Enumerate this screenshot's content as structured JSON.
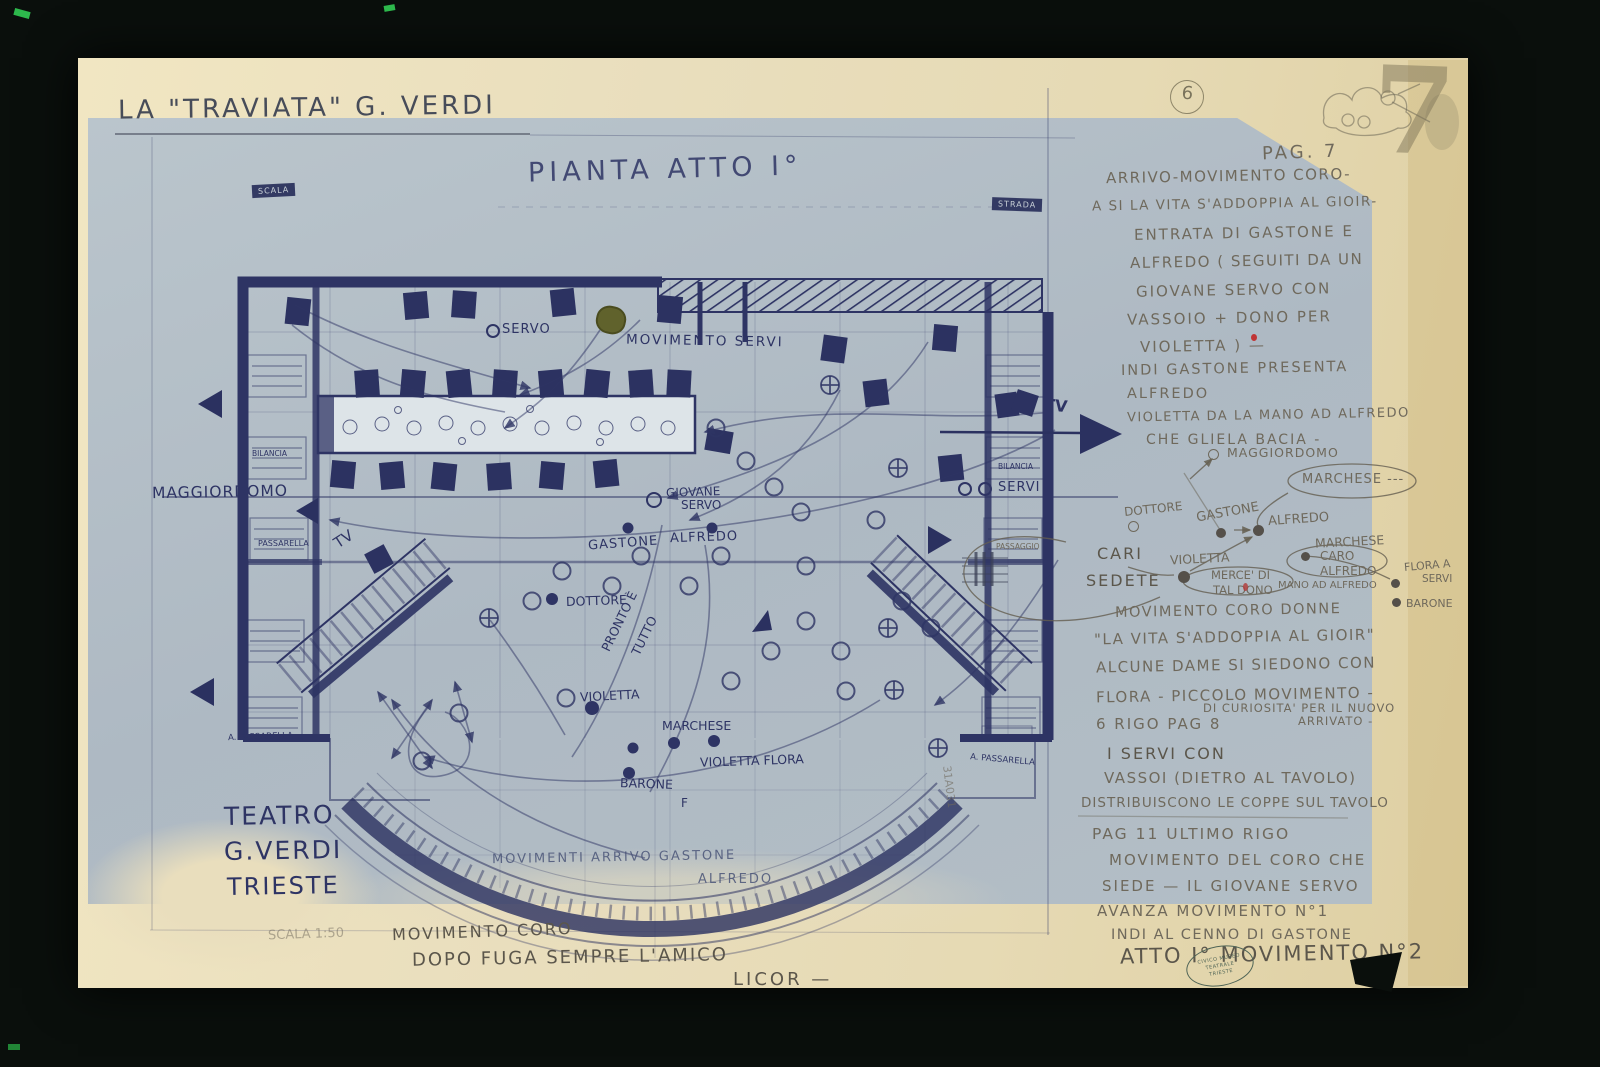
{
  "document": {
    "header_title": "LA \"TRAVIATA\"  G. VERDI",
    "plan_title": "PIANTA ATTO I°",
    "page_circled": "6",
    "page_watermark": "7",
    "theater": {
      "line1": "TEATRO",
      "line2": "G.VERDI",
      "line3": "TRIESTE",
      "scale": "SCALA 1:50"
    },
    "footer": {
      "line1": "MOVIMENTO CORO",
      "line2": "DOPO FUGA SEMPRE L'AMICO",
      "line3": "LICOR —"
    },
    "stamp": {
      "line1": "CIVICO MUSEO",
      "line2": "TEATRALE",
      "line3": "TRIESTE"
    }
  },
  "notes": {
    "pag": "PAG. 7",
    "p1l1": "ARRIVO-MOVIMENTO CORO-",
    "p1l2": "A SI LA VITA S'ADDOPPIA AL GIOIR-",
    "p1l3": "ENTRATA DI GASTONE E",
    "p1l4": "ALFREDO ( SEGUITI DA UN",
    "p1l5": "GIOVANE SERVO CON",
    "p1l6": "VASSOIO + DONO PER",
    "p1l7": "VIOLETTA ) —",
    "p2l1": "INDI GASTONE PRESENTA",
    "p2l2": "ALFREDO",
    "p3l1": "VIOLETTA DA LA MANO AD ALFREDO",
    "p3l2": "CHE GLIELA BACIA -",
    "p4l1": "MOVIMENTO CORO DONNE",
    "p4l2": "\"LA VITA S'ADDOPPIA AL GIOIR\"",
    "p4l3": "ALCUNE DAME SI SIEDONO CON",
    "p4l4": "FLORA - PICCOLO MOVIMENTO -",
    "p4l5": "DI CURIOSITA' PER IL NUOVO",
    "p4l6": "ARRIVATO -",
    "p4l7": "6 RIGO PAG 8",
    "p5l1": "I SERVI CON",
    "p5l2": "VASSOI (DIETRO AL TAVOLO)",
    "p5l3": "DISTRIBUISCONO LE COPPE SUL TAVOLO",
    "p6l1": "PAG 11 ULTIMO RIGO",
    "p6l2": "MOVIMENTO DEL CORO CHE",
    "p6l3": "SIEDE — IL GIOVANE SERVO",
    "p6l4": "AVANZA MOVIMENTO N°1",
    "p6l5": "INDI AL CENNO DI GASTONE",
    "atto": "ATTO I° MOVIMENTO N°2"
  },
  "cluster": {
    "maggiordomo": "MAGGIORDOMO",
    "marchese_bubble": "MARCHESE ---",
    "dottore": "DOTTORE",
    "gastone": "GASTONE",
    "alfredo": "ALFREDO",
    "marchese": "MARCHESE",
    "cari": "CARI",
    "sedete": "SEDETE",
    "violetta": "VIOLETTA",
    "caro1": "CARO",
    "caro2": "ALFREDO",
    "merce1": "MERCE' DI",
    "merce2": "TAL DONO",
    "mano": "MANO AD ALFREDO",
    "flora1": "FLORA A",
    "flora2": "SERVI",
    "barone": "BARONE"
  },
  "stage": {
    "scala_box": "SCALA",
    "strada_box": "STRADA",
    "servo": "SERVO",
    "movimento_servi": "MOVIMENTO SERVI",
    "tv_left": "TV",
    "tv_right": "TV",
    "maggiordomo": "MAGGIORDOMO",
    "passarella": "PASSARELLA",
    "bilancia_left": "BILANCIA",
    "bilancia_right": "BILANCIA",
    "passaggio": "PASSAGGIO",
    "servi": "SERVI",
    "giovane1": "GIOVANE",
    "giovane2": "SERVO",
    "gastone": "GASTONE",
    "alfredo": "ALFREDO",
    "dottore": "DOTTORE",
    "pronto1": "PRONTO È",
    "pronto2": "TUTTO",
    "violetta": "VIOLETTA",
    "marchese": "MARCHESE",
    "violetta_flora": "VIOLETTA  FLORA",
    "barone": "BARONE",
    "f_mark": "F",
    "arrivo1": "MOVIMENTI ARRIVO GASTONE",
    "arrivo2": "ALFREDO",
    "pass_bl": "A. PASSARELLA",
    "pass_br": "A. PASSARELLA",
    "serial": "31A031"
  }
}
